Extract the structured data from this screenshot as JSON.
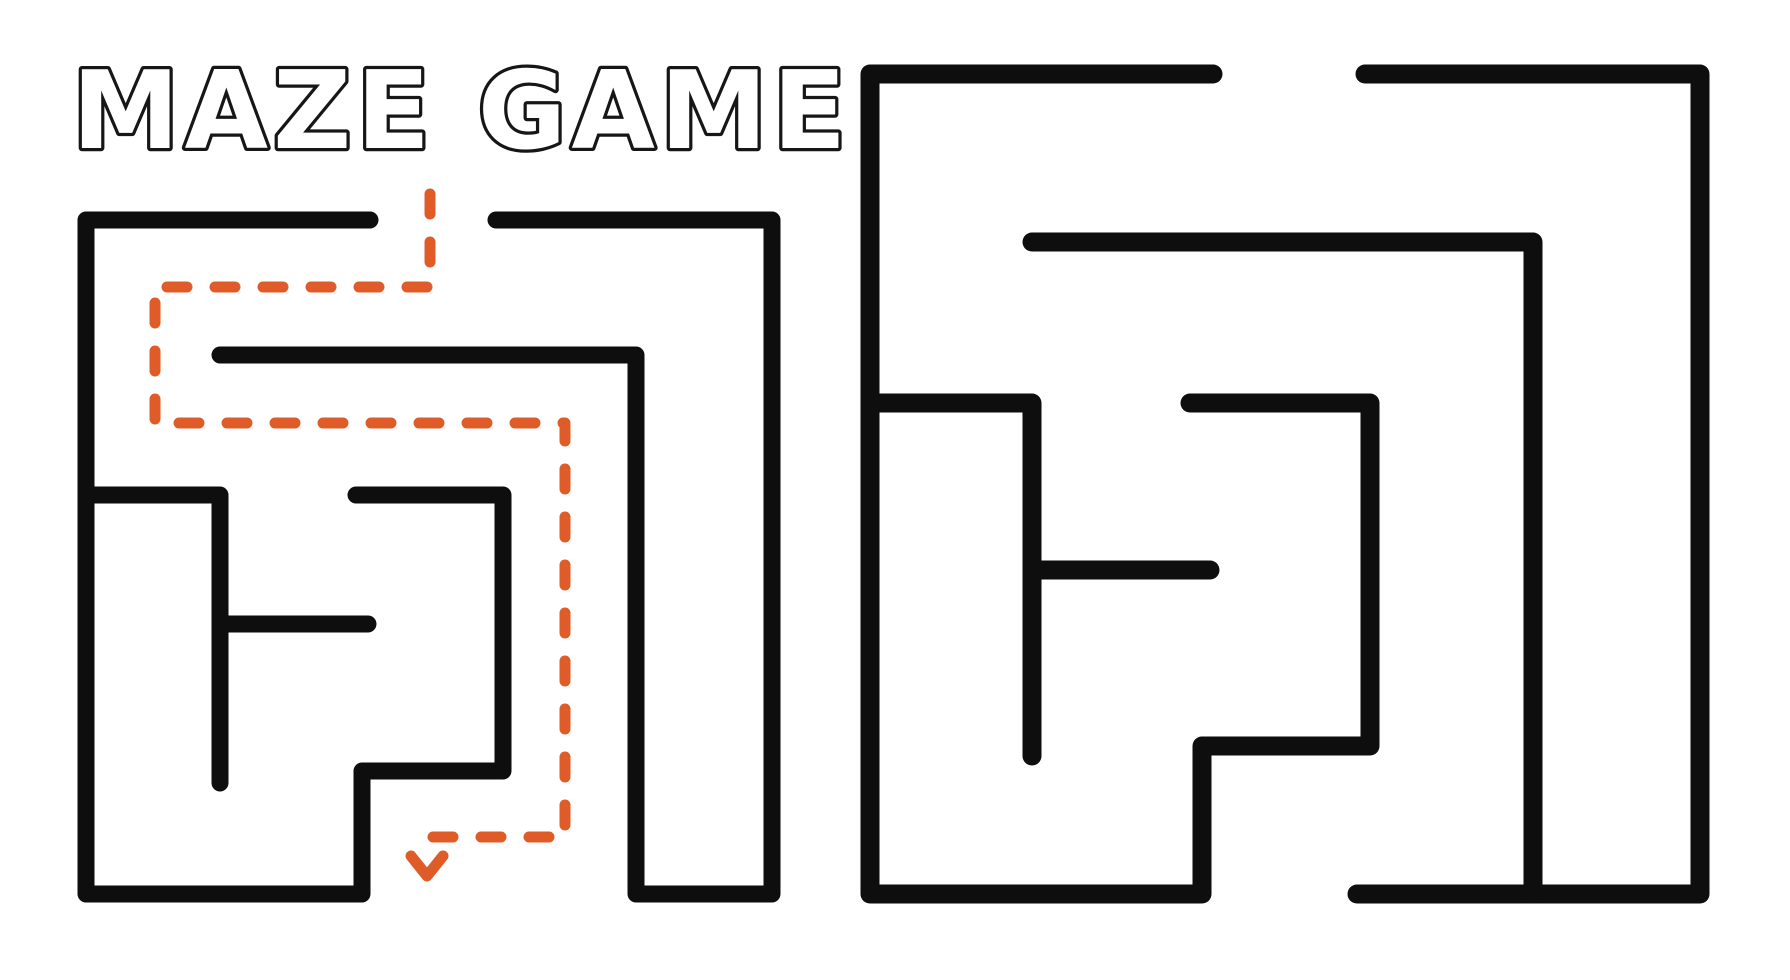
{
  "page": {
    "width": 1790,
    "height": 980,
    "background": "#ffffff"
  },
  "title": {
    "text": "MAZE GAME",
    "style": "hand-drawn bubble outline letters",
    "fill_color": "#ffffff",
    "outline_color": "#161616",
    "outline_width": 6.5,
    "x": 72,
    "baseline_y": 148
  },
  "colors": {
    "wall": "#0e0e0e",
    "solution": "#df5c28"
  },
  "left_maze": {
    "name": "maze-with-solution",
    "entrance": "top gap",
    "exit": "bottom gap",
    "stroke_width": 17,
    "wall_paths": [
      [
        [
          356,
          495
        ],
        [
          503,
          495
        ],
        [
          503,
          771
        ],
        [
          362,
          771
        ],
        [
          362,
          894
        ],
        [
          86,
          894
        ],
        [
          86,
          220
        ],
        [
          370,
          220
        ]
      ],
      [
        [
          496,
          220
        ],
        [
          772,
          220
        ],
        [
          772,
          894
        ],
        [
          636,
          894
        ],
        [
          636,
          355
        ],
        [
          220,
          355
        ]
      ],
      [
        [
          86,
          495
        ],
        [
          220,
          495
        ],
        [
          220,
          783
        ]
      ],
      [
        [
          220,
          624
        ],
        [
          368,
          624
        ]
      ]
    ],
    "solution": {
      "shown": true,
      "stroke_width": 11,
      "dash_on": 20,
      "dash_off": 28,
      "path": [
        [
          430,
          194
        ],
        [
          430,
          287
        ],
        [
          155,
          287
        ],
        [
          155,
          423
        ],
        [
          565,
          423
        ],
        [
          565,
          837
        ],
        [
          427,
          837
        ],
        [
          427,
          852
        ]
      ],
      "arrowhead": [
        [
          411,
          856
        ],
        [
          427,
          876
        ],
        [
          443,
          856
        ]
      ],
      "direction": "enters at top, exits at bottom with down arrow"
    }
  },
  "right_maze": {
    "name": "maze-unsolved",
    "entrance": "top gap",
    "exit": "bottom gap",
    "stroke_width": 19,
    "wall_paths": [
      [
        [
          1190,
          403
        ],
        [
          1370,
          403
        ],
        [
          1370,
          746
        ],
        [
          1202,
          746
        ],
        [
          1202,
          894
        ],
        [
          870,
          894
        ],
        [
          870,
          74
        ],
        [
          1213,
          74
        ]
      ],
      [
        [
          1365,
          74
        ],
        [
          1700,
          74
        ],
        [
          1700,
          894
        ],
        [
          1357,
          894
        ]
      ],
      [
        [
          1533,
          894
        ],
        [
          1533,
          242
        ],
        [
          1032,
          242
        ]
      ],
      [
        [
          870,
          403
        ],
        [
          1032,
          403
        ],
        [
          1032,
          756
        ]
      ],
      [
        [
          1032,
          570
        ],
        [
          1210,
          570
        ]
      ]
    ],
    "solution": {
      "shown": false
    }
  }
}
